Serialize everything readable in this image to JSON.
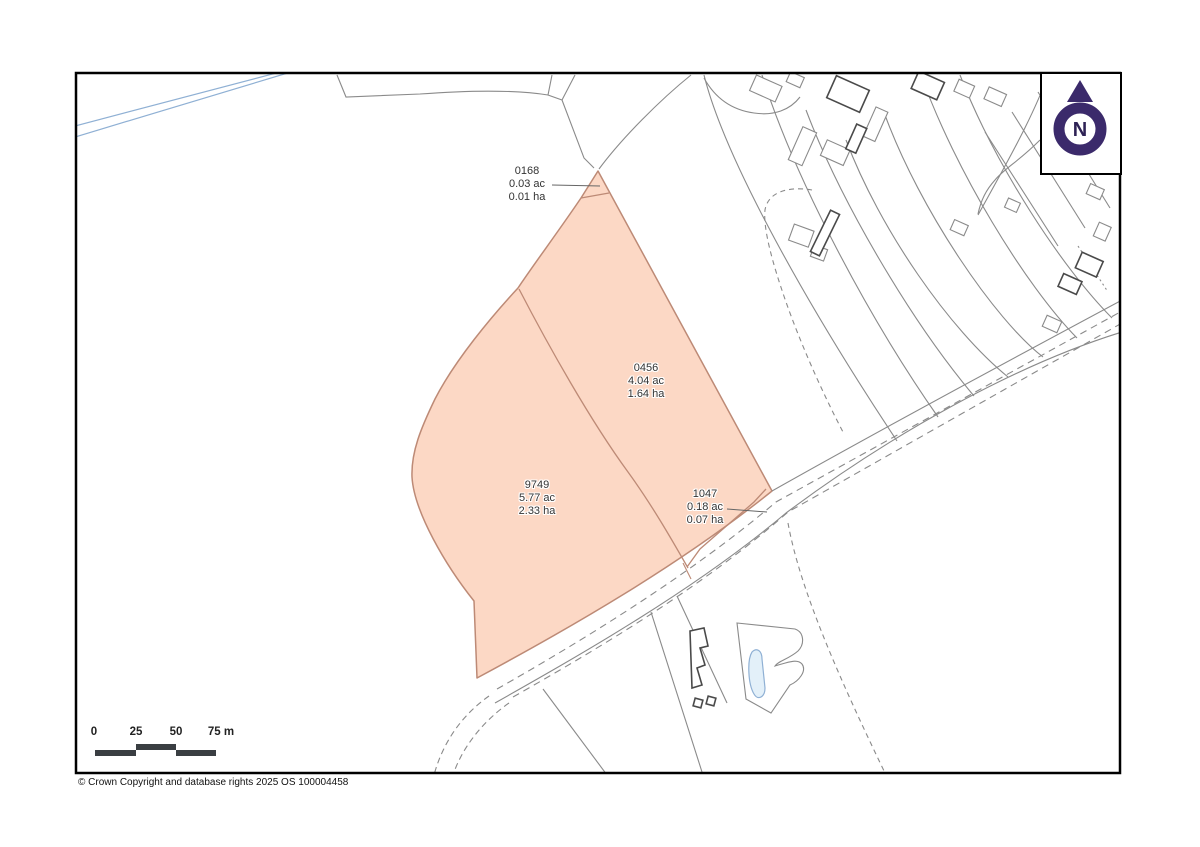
{
  "parcels": [
    {
      "id": "0168",
      "area_acres": "0.03 ac",
      "area_hectares": "0.01 ha"
    },
    {
      "id": "0456",
      "area_acres": "4.04 ac",
      "area_hectares": "1.64 ha"
    },
    {
      "id": "9749",
      "area_acres": "5.77 ac",
      "area_hectares": "2.33 ha"
    },
    {
      "id": "1047",
      "area_acres": "0.18 ac",
      "area_hectares": "0.07 ha"
    }
  ],
  "north_indicator": {
    "label": "N",
    "icon": "north-arrow-icon"
  },
  "scale_bar": {
    "labels": [
      "0",
      "25",
      "50",
      "75 m"
    ]
  },
  "copyright": "© Crown Copyright and database rights 2025 OS 100004458",
  "colors": {
    "parcel_fill": "#fcd8c5",
    "parcel_outline": "#bd8a76",
    "map_lines": "#8a8a8a",
    "buildings": "#4a4a4a",
    "water": "#8fb0d4",
    "north_emblem": "#3b2a6b",
    "scale_bar": "#3a3e42"
  }
}
